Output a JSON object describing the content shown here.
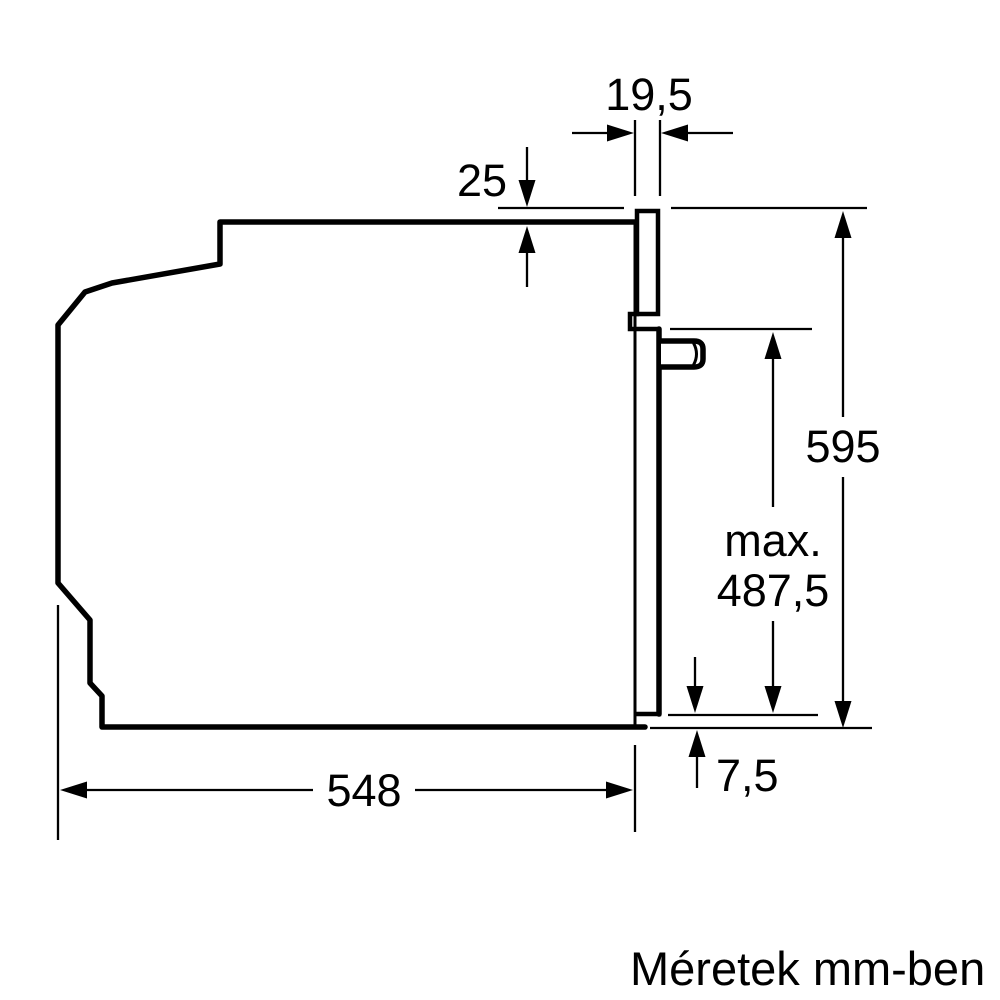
{
  "diagram": {
    "caption": "Méretek mm-ben",
    "line_color": "#000000",
    "background_color": "#ffffff",
    "dimensions": {
      "front_panel_depth": {
        "value": "19,5"
      },
      "top_overlap": {
        "value": "25"
      },
      "total_height": {
        "value": "595"
      },
      "door_clearance": {
        "prefix": "max.",
        "value": "487,5"
      },
      "bottom_gap": {
        "value": "7,5"
      },
      "body_depth": {
        "value": "548"
      }
    }
  }
}
